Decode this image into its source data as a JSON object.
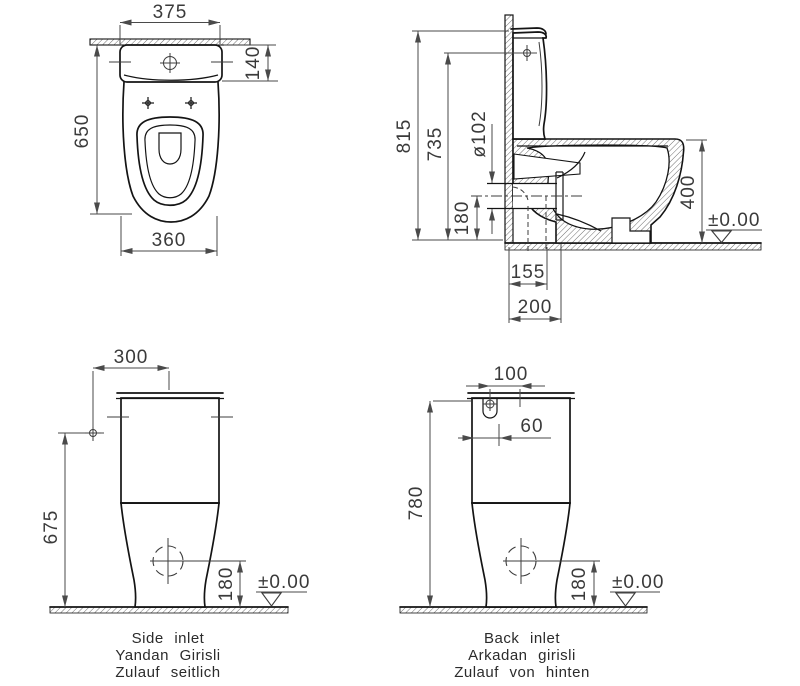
{
  "colors": {
    "background": "#ffffff",
    "object_line": "#141414",
    "dimension_line": "#4a4a4a",
    "text": "#3a3a3a"
  },
  "views": {
    "plan": {
      "dims": {
        "overall_width": "375",
        "tank_depth": "140",
        "overall_depth": "650",
        "bowl_width": "360"
      }
    },
    "section": {
      "dims": {
        "total_height": "815",
        "inlet_height": "735",
        "outlet_diameter": "ø102",
        "outlet_center_height": "180",
        "rim_height": "400",
        "floor_level": "±0.00",
        "outlet_distance": "155",
        "flange_distance": "200"
      }
    },
    "side_inlet": {
      "dims": {
        "inlet_offset": "300",
        "inlet_height": "675",
        "outlet_center_height": "180",
        "floor_level": "±0.00"
      },
      "caption": {
        "en": "Side inlet",
        "tr": "Yandan Girisli",
        "de": "Zulauf seitlich"
      }
    },
    "back_inlet": {
      "dims": {
        "center_to_inlet": "100",
        "edge_to_inlet": "60",
        "inlet_height": "780",
        "outlet_center_height": "180",
        "floor_level": "±0.00"
      },
      "caption": {
        "en": "Back inlet",
        "tr": "Arkadan girisli",
        "de": "Zulauf von hinten"
      }
    }
  }
}
